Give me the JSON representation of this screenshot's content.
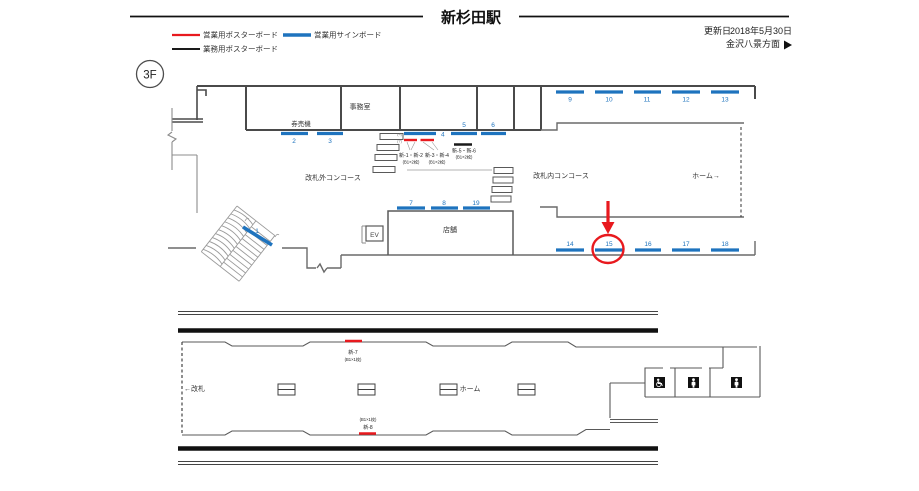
{
  "page": {
    "title": "新杉田駅",
    "updated_label": "更新日",
    "updated_date": "2018年5月30日",
    "direction_label": "金沢八景方面",
    "floor": "3F"
  },
  "legend": [
    {
      "label": "営業用ポスターボード",
      "color": "#e8191e"
    },
    {
      "label": "営業用サインボード",
      "color": "#1e73be"
    },
    {
      "label": "業務用ポスターボード",
      "color": "#1a1a1a"
    }
  ],
  "colors": {
    "sign_blue": "#1e73be",
    "poster_red": "#e8191e",
    "office_black": "#1a1a1a",
    "highlight_red": "#e8191e"
  },
  "upper_plan": {
    "labels": {
      "office": "事務室",
      "ticket_machines": "券売機",
      "outside_concourse": "改札外コンコース",
      "inside_concourse": "改札内コンコース",
      "platform": "ホーム→",
      "shop": "店舗",
      "elevator": "EV"
    },
    "sign_numbers": [
      "1",
      "2",
      "3",
      "4",
      "5",
      "6",
      "7",
      "8",
      "9",
      "10",
      "11",
      "12",
      "13",
      "14",
      "15",
      "16",
      "17",
      "18",
      "19"
    ],
    "tiny_label_top": "(4)",
    "tiny_label_bottom": "(7)",
    "poster_labels": [
      {
        "id": "新-1・新-2",
        "size": "(B1×2枚)"
      },
      {
        "id": "新-3・新-4",
        "size": "(B1×2枚)"
      },
      {
        "id": "新-5・新-6",
        "size": "(B1×2枚)"
      }
    ],
    "highlighted_sign": "15"
  },
  "lower_plan": {
    "labels": {
      "gate": "←改札",
      "platform": "ホーム"
    },
    "poster_labels": [
      {
        "id": "新-7",
        "size": "(B1×1枚)"
      },
      {
        "id": "新-8",
        "size": "(B1×1枚)"
      }
    ]
  }
}
